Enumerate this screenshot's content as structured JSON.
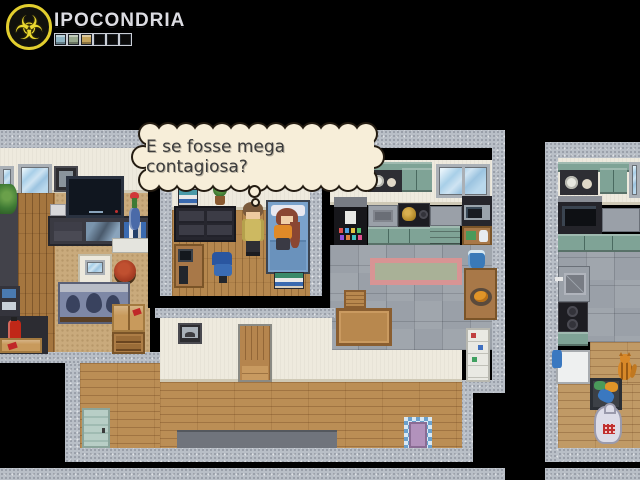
{
  "hud": {
    "title": "IPOCONDRIA",
    "logo_icon": "biohazard-icon",
    "meter": {
      "label": "hypochondria-meter",
      "cells": [
        {
          "filled": true,
          "color": "#8fb4c2"
        },
        {
          "filled": true,
          "color": "#97a78c"
        },
        {
          "filled": true,
          "color": "#c4a45c"
        },
        {
          "filled": false,
          "color": "#0a0a0a"
        },
        {
          "filled": false,
          "color": "#0a0a0a"
        },
        {
          "filled": false,
          "color": "#0a0a0a"
        }
      ]
    }
  },
  "dialogue": {
    "style": "thought-bubble",
    "text": "E se fosse mega contagiosa?",
    "fill_color": "#f7eed9",
    "border_color": "#241c12"
  },
  "scene": {
    "view": "top-down apartment interiors",
    "rooms": [
      "living-room",
      "bedroom-inset",
      "kitchen",
      "hallway",
      "neighbor-kitchen"
    ],
    "characters": [
      {
        "name": "player",
        "hair_color": "#7a5a3c",
        "outfit_color": "#cdb961",
        "pose": "standing"
      },
      {
        "name": "npc-girl",
        "hair_color": "#8a4632",
        "outfit_color": "#e08a28",
        "pose": "sitting-on-bed"
      }
    ],
    "colors": {
      "background": "#000000",
      "concrete_wall": "#b9bfc7",
      "interior_wall": "#eeeade",
      "wood_floor": "#bb8e55",
      "carpet": "#c9aa7c",
      "tile_floor": "#9aa0a8",
      "cabinet_teal": "#7fa396",
      "bed_blue": "#7aa2cc"
    }
  }
}
